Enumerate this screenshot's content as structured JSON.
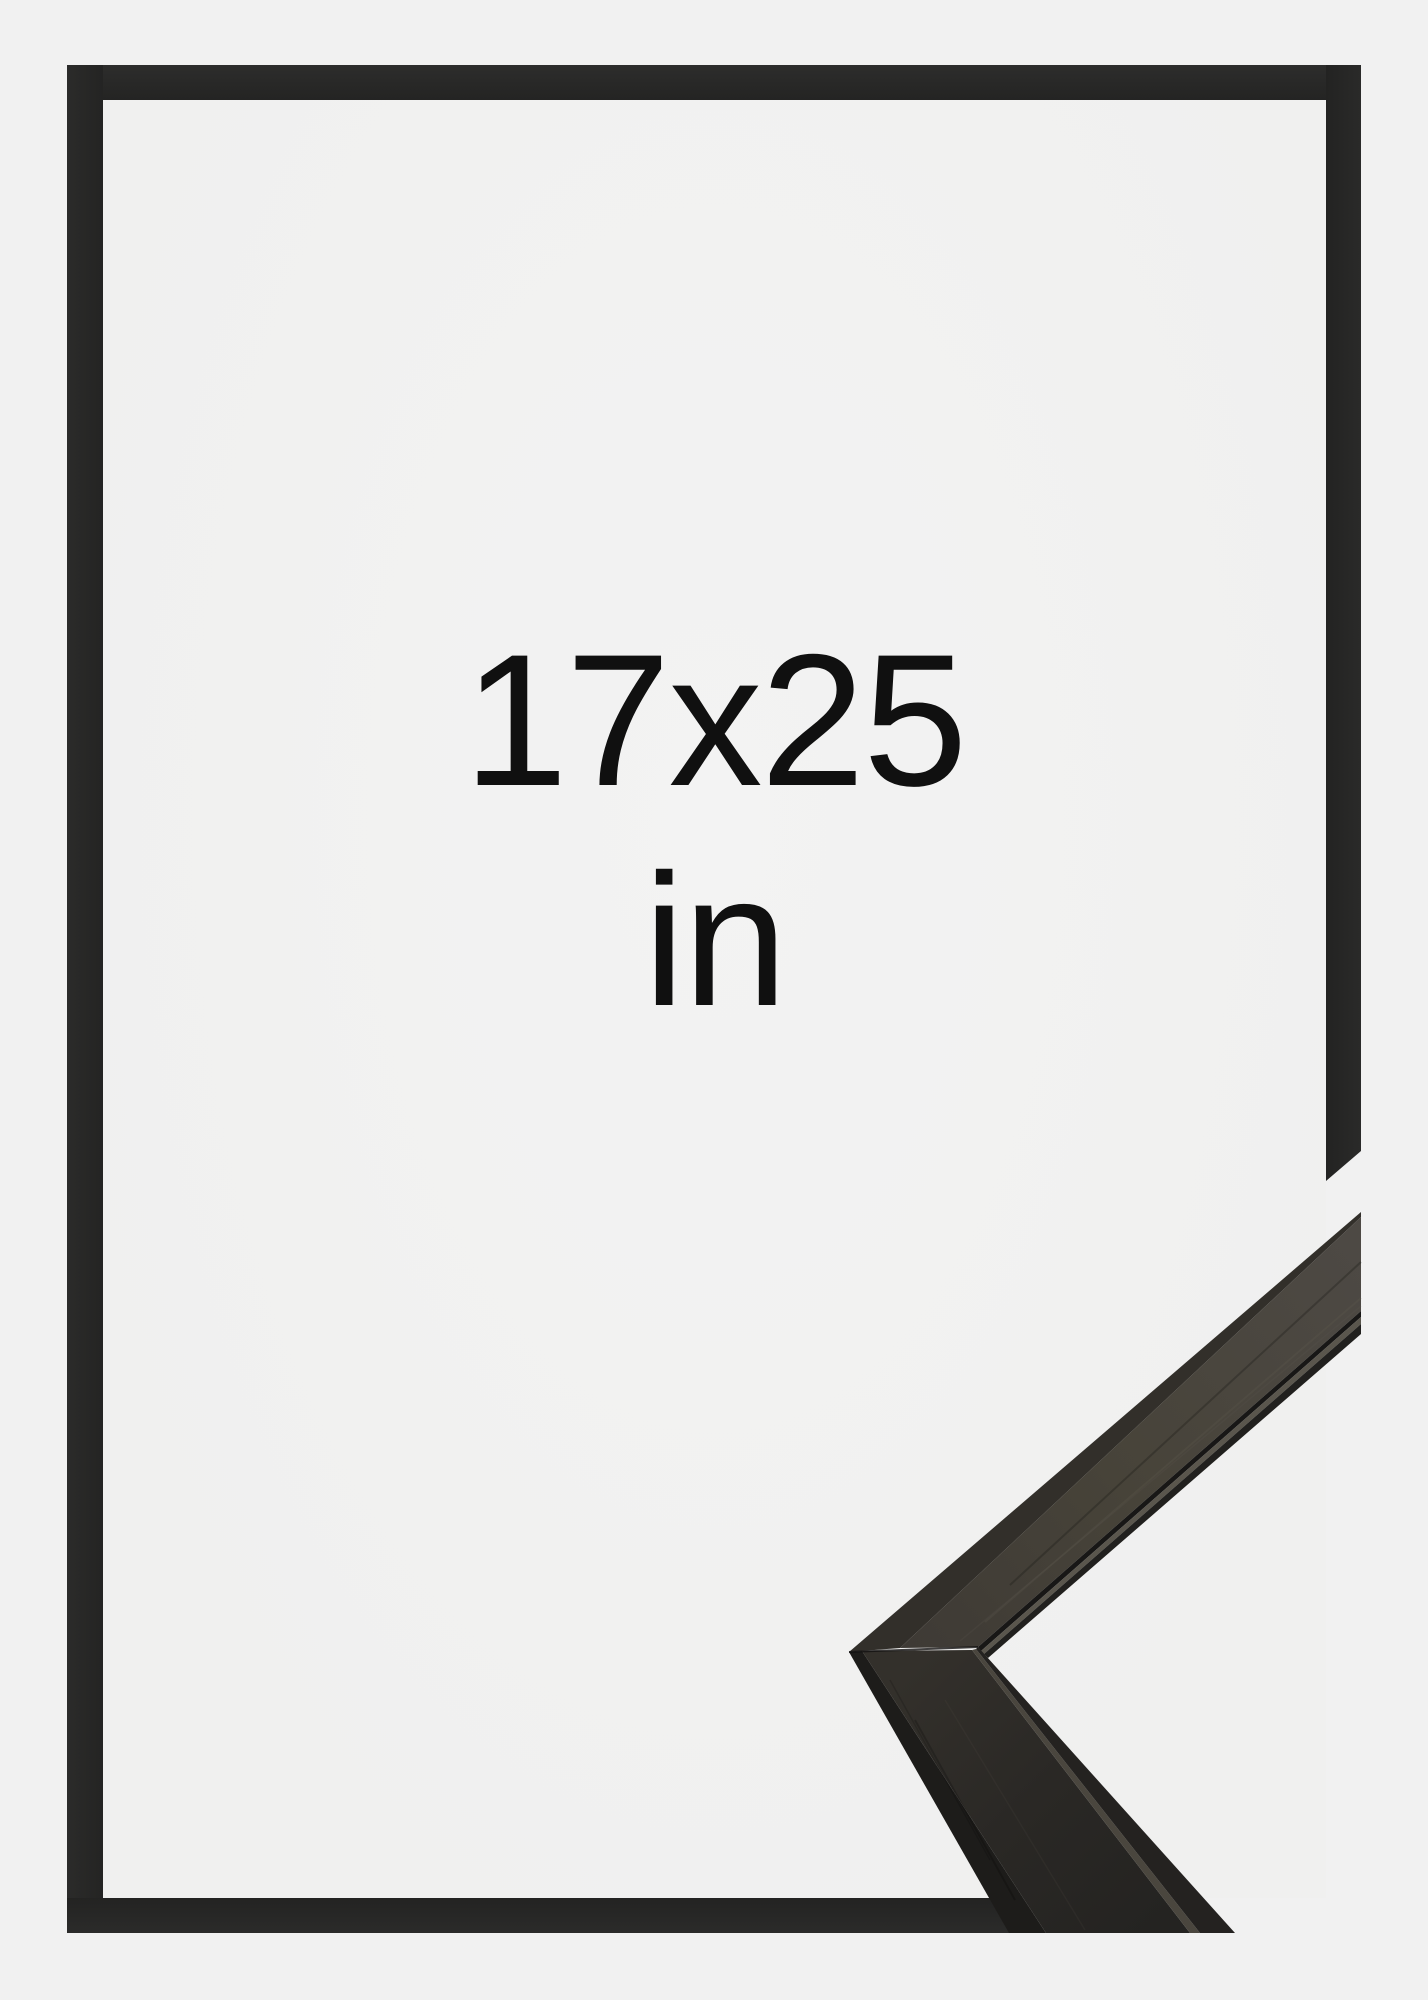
{
  "product_image": {
    "size_label": {
      "dimensions": "17x25",
      "unit": "in"
    },
    "colors": {
      "background": "#f1f1f1",
      "frame_border": "#272726",
      "label_text": "#101010",
      "moulding_top_face": "#4a463f",
      "moulding_side_face": "#1d1c1a",
      "moulding_ridge_highlight": "#59554c"
    }
  }
}
